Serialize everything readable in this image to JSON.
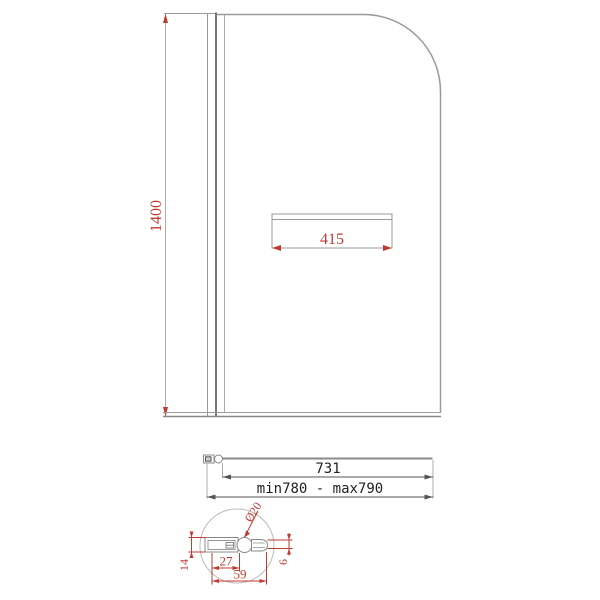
{
  "front_view": {
    "height_label": "1400",
    "handle_width_label": "415"
  },
  "plan_view": {
    "glass_width_label": "731",
    "adjustment_range_label": "min780 - max790"
  },
  "detail_view": {
    "pivot_diameter_label": "Ø20",
    "wall_profile_width_label": "27",
    "total_depth_label": "59",
    "profile_height_label": "14",
    "glass_thickness_label": "6"
  },
  "colors": {
    "dimension_red": "#c03b32",
    "outline_gray": "#999999",
    "dark_line": "#777777"
  }
}
